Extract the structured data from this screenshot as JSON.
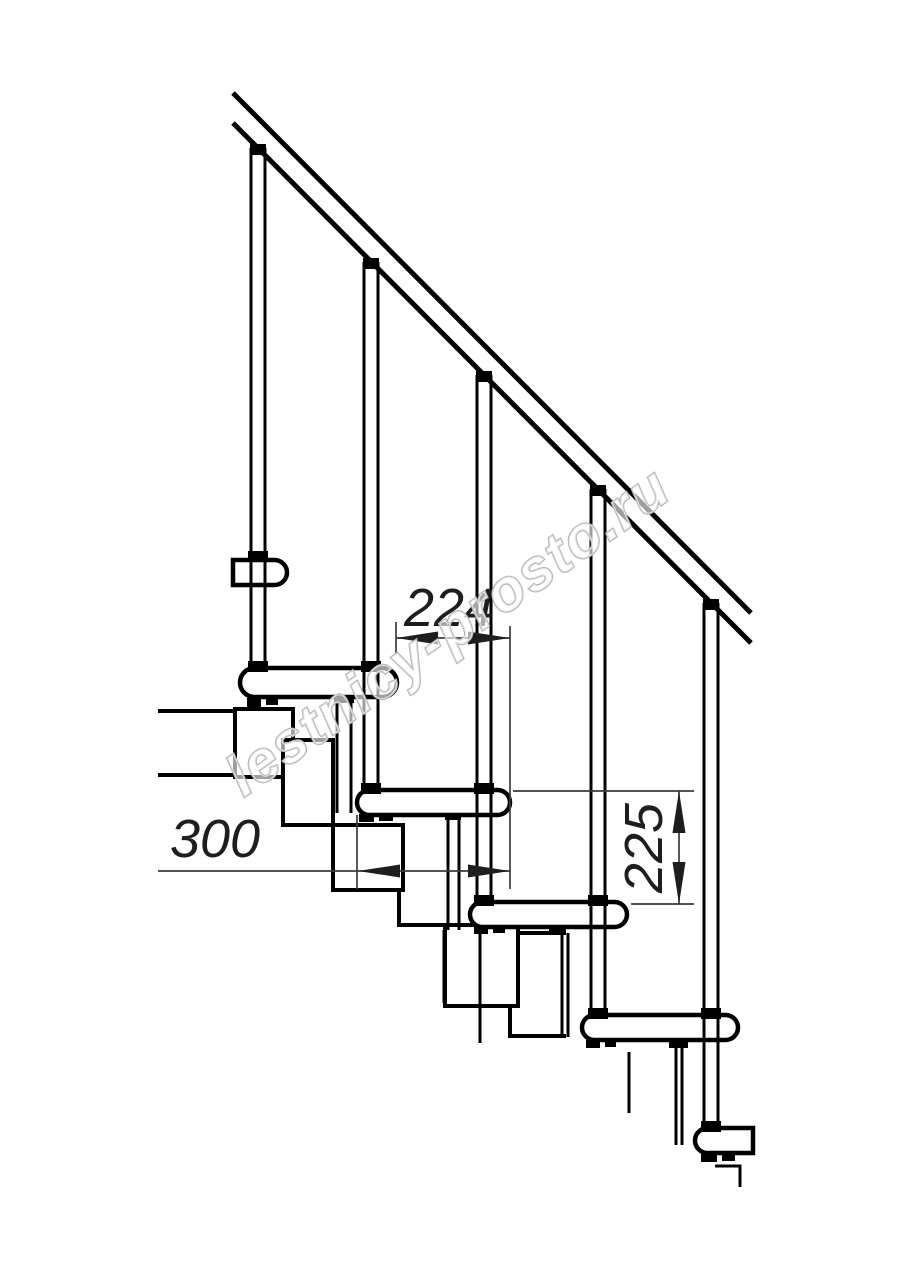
{
  "diagram": {
    "kind": "staircase-side-elevation",
    "colors": {
      "line": "#000000",
      "dimension": "#3c3c3c",
      "background": "#ffffff",
      "watermark": "#b4b4b4"
    },
    "structure": {
      "balusters_visible": 5,
      "treads_visible": 6
    },
    "dimensions": {
      "run_between_posts": "224",
      "tread_depth": "300",
      "step_rise": "225"
    },
    "watermark": {
      "text": "lestnicy-prosto.ru"
    }
  }
}
